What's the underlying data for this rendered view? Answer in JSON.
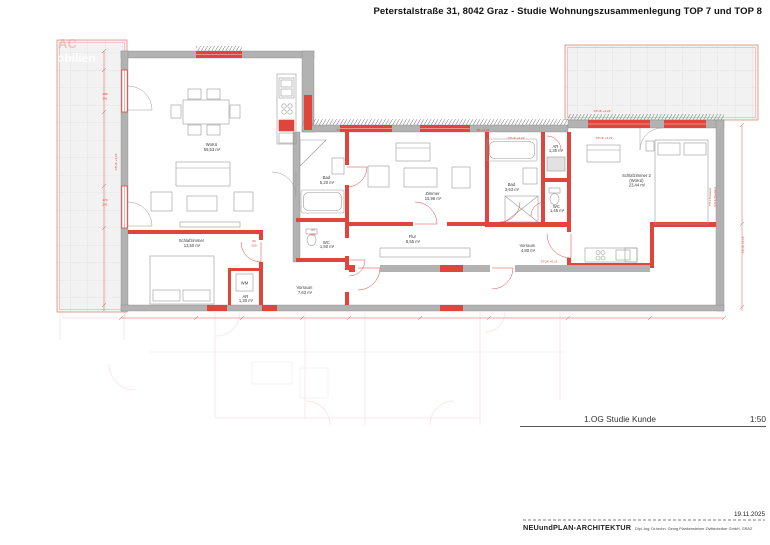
{
  "title": "Peterstalstraße 31, 8042 Graz - Studie Wohnungszusammenlegung TOP 7 und TOP 8",
  "watermark": {
    "line1": "AC",
    "line2": "obilien"
  },
  "colors": {
    "plan_red": "#df453c",
    "wall_gray": "#b2b2b2",
    "tile_border_red": "#dd8d86",
    "ghost_pink": "#eec3bf"
  },
  "rooms": [
    {
      "name": "WoKü",
      "area": "55,53 m²"
    },
    {
      "name": "Schlafzimmer",
      "area": "13,50 m²"
    },
    {
      "name": "AR",
      "area": "1,30 m²"
    },
    {
      "name": "Vorraum",
      "area": "7,63 m²"
    },
    {
      "name": "WC",
      "area": "1,50 m²"
    },
    {
      "name": "Bad",
      "area": "5,20 m²"
    },
    {
      "name": "Zimmer",
      "area": "15,96 m²"
    },
    {
      "name": "Flur",
      "area": "8,55 m²"
    },
    {
      "name": "Bad",
      "area": "3,63 m²"
    },
    {
      "name": "AR",
      "area": "1,30 m²"
    },
    {
      "name": "WC",
      "area": "1,45 m²"
    },
    {
      "name": "Schlafzimmer 2",
      "sub": "(WoKü)",
      "area": "23,44 m²"
    },
    {
      "name": "Vorraum",
      "area": "4,80 m²"
    }
  ],
  "annotations": {
    "wm_appliance": "WM",
    "lvl": "STUK +4,22",
    "lvl_bk": "BK +4,22",
    "lvl_low": "STUK +0,11",
    "win1_w": "288",
    "win1_h": "241",
    "win2_w": "170",
    "win2_h": "241",
    "door_w": "80",
    "door_h": "200",
    "right_note1": "TH4 Bestand",
    "right_note2": "STLK Bestand"
  },
  "titleblock": {
    "drawing_title": "1.OG Studie Kunde",
    "scale": "1:50"
  },
  "footer": {
    "date": "19.11.2025",
    "firm": "NEUundPLAN-ARCHITEKTUR",
    "firm_detail": "Dipl.-Ing. Dr.techn. Georg Plankensteiner Ziviltechniker GmbH, GRAZ"
  }
}
